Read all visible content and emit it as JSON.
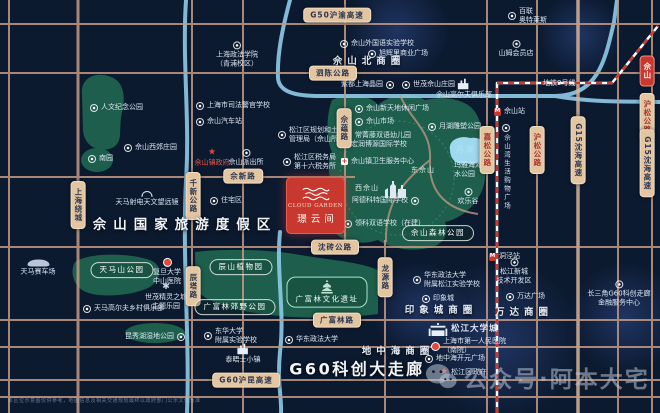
{
  "project": {
    "name_en": "CLOUD GARDEN",
    "name_cn": "璟云间"
  },
  "watermark": {
    "text": "公众号·阿本大宅"
  },
  "disclaimer": "本区位示意图仅供参考，地图信息及相关交通规划最终以政府部门公示文件为准",
  "metro": {
    "line": "地铁9号线",
    "stations": [
      "佘山站",
      "洞泾站"
    ]
  },
  "colors": {
    "background": "#0c1a30",
    "road": "#c49a85",
    "road_badge": "#e3c5a2",
    "park_green": "#1d5f4c",
    "river_blue": "#8ecbe8",
    "lake_blue": "#9ed9ef",
    "metro_red": "#cc3a31",
    "project_red": "#c9382e",
    "accent_red_text": "#e85548"
  },
  "labels": [
    {
      "n": "badge-g50-huyu-expwy",
      "k": "bh",
      "t": "G50沪渝高速",
      "x": 337,
      "y": 15
    },
    {
      "n": "badge-sichen-road",
      "k": "bh",
      "t": "泗陈公路",
      "x": 333,
      "y": 73
    },
    {
      "n": "badge-shexin-road",
      "k": "bh",
      "t": "佘新路",
      "x": 243,
      "y": 176
    },
    {
      "n": "badge-shenzhuan-road",
      "k": "bh",
      "t": "沈砖公路",
      "x": 335,
      "y": 247
    },
    {
      "n": "badge-guangfulin-road",
      "k": "bh",
      "t": "广富林路",
      "x": 337,
      "y": 320
    },
    {
      "n": "badge-g60-hukun-expwy",
      "k": "bh",
      "t": "G60沪昆高速",
      "x": 246,
      "y": 380
    },
    {
      "n": "badge-shanghai-ring-expwy",
      "k": "bv",
      "t": "上海绕城",
      "x": 78,
      "y": 205
    },
    {
      "n": "badge-qianxin-road",
      "k": "bv",
      "t": "千新公路",
      "x": 193,
      "y": 196
    },
    {
      "n": "badge-chenta-road",
      "k": "bv",
      "t": "辰塔路",
      "x": 193,
      "y": 286
    },
    {
      "n": "badge-sheyun-road",
      "k": "bv",
      "t": "佘蕴路",
      "x": 344,
      "y": 128
    },
    {
      "n": "badge-longyuan-road",
      "k": "bv",
      "t": "龙源路",
      "x": 385,
      "y": 277
    },
    {
      "n": "badge-jiasong-road",
      "k": "bvr",
      "t": "嘉松公路",
      "x": 487,
      "y": 150
    },
    {
      "n": "badge-husong-road",
      "k": "bvr",
      "t": "沪松公路",
      "x": 537,
      "y": 150
    },
    {
      "n": "badge-g15-shenhai-expwy",
      "k": "bv",
      "t": "G15沈海高速",
      "x": 578,
      "y": 150
    },
    {
      "n": "badge-sheshan-red",
      "k": "bbox",
      "t": "佘山",
      "x": 647,
      "y": 71
    },
    {
      "n": "badge-husong-road-east",
      "k": "bvr",
      "t": "沪松公路",
      "x": 647,
      "y": 117
    },
    {
      "n": "badge-g15-shenhai-expwy-east",
      "k": "bv",
      "t": "G15沈海高速",
      "x": 647,
      "y": 163
    },
    {
      "n": "park-badge-tianmashan",
      "k": "park",
      "t": "天马山公园",
      "x": 122,
      "y": 270
    },
    {
      "n": "park-badge-chenshan-botanical",
      "k": "park",
      "t": "辰山植物园",
      "x": 241,
      "y": 267
    },
    {
      "n": "park-badge-guangfulin-country",
      "k": "park",
      "t": "广富林郊野公园",
      "x": 235,
      "y": 307
    },
    {
      "n": "park-badge-guangfulin-relics",
      "k": "gpark",
      "t": "广富林文化遗址",
      "x": 327,
      "y": 292,
      "i": "pagoda",
      "ip": "above"
    },
    {
      "n": "park-badge-sheshan-forest",
      "k": "park",
      "t": "佘山森林公园",
      "x": 438,
      "y": 233
    },
    {
      "n": "title-sheshan-resort",
      "k": "title",
      "t": "佘山国家旅游度假区",
      "x": 185,
      "y": 226
    },
    {
      "n": "title-g60-corridor",
      "k": "g60",
      "t": "G60科创大走廊",
      "x": 357,
      "y": 370
    },
    {
      "n": "circle-dizhonghai",
      "k": "spread",
      "t": "地中海商圈",
      "x": 398,
      "y": 352
    },
    {
      "n": "circle-yinxiangcheng",
      "k": "spread",
      "t": "印象城商圈",
      "x": 441,
      "y": 311
    },
    {
      "n": "circle-wanda",
      "k": "spread",
      "t": "万达商圈",
      "x": 524,
      "y": 313
    },
    {
      "n": "circle-sheshan-north",
      "k": "spread",
      "t": "佘山北商圈",
      "x": 369,
      "y": 62
    },
    {
      "n": "metro-line9-label",
      "k": "poi",
      "t": "地铁9号线",
      "x": 543,
      "y": 79
    },
    {
      "n": "station-sheshan",
      "k": "poi",
      "t": "佘山站",
      "x": 494,
      "y": 107,
      "i": "metro"
    },
    {
      "n": "station-dongjing",
      "k": "poi",
      "t": "洞泾站",
      "x": 489,
      "y": 252,
      "i": "metro"
    },
    {
      "n": "poi-renwen-memorial-park",
      "k": "poi",
      "t": "人文纪念公园",
      "x": 90,
      "y": 103,
      "i": "circle"
    },
    {
      "n": "poi-nanyuan",
      "k": "poi",
      "t": "南园",
      "x": 88,
      "y": 154,
      "i": "circle"
    },
    {
      "n": "poi-sheshan-xijiao-manor",
      "k": "poi",
      "t": "佘山西郊庄园",
      "x": 124,
      "y": 143,
      "i": "circle"
    },
    {
      "n": "poi-shanghai-univ-political-law",
      "k": "poic",
      "L": [
        "上海政法学院",
        "（青浦校区）"
      ],
      "x": 237,
      "y": 55,
      "i": "circle",
      "ip": "above"
    },
    {
      "n": "poi-judicial-police-school",
      "k": "poi",
      "t": "上海市司法警官学校",
      "x": 196,
      "y": 101,
      "i": "circle"
    },
    {
      "n": "poi-sheshan-bus-station",
      "k": "poi",
      "t": "佘山汽车站",
      "x": 196,
      "y": 117,
      "i": "circle"
    },
    {
      "n": "poi-planning-land-bureau",
      "k": "poi",
      "L": [
        "松江区规划和土地",
        "管理局（佘山所）"
      ],
      "x": 278,
      "y": 126,
      "i": "circle"
    },
    {
      "n": "poi-tax-office-16",
      "k": "poi",
      "L": [
        "松江区税务局",
        "第十六税务所"
      ],
      "x": 283,
      "y": 153,
      "i": "circle"
    },
    {
      "n": "poi-sheshan-town-gov",
      "k": "poic",
      "t": "佘山镇政府",
      "x": 212,
      "y": 158,
      "i": "star",
      "ip": "above",
      "red": 1
    },
    {
      "n": "poi-sheshan-police-station",
      "k": "poic",
      "t": "佘山派出所",
      "x": 246,
      "y": 158,
      "i": "circle",
      "ip": "above"
    },
    {
      "n": "poi-residential-area",
      "k": "poi",
      "t": "住宅区",
      "x": 210,
      "y": 196,
      "i": "circle"
    },
    {
      "n": "poi-tianma-radio-telescope",
      "k": "poic",
      "t": "天马射电天文望远镜",
      "x": 147,
      "y": 199,
      "i": "dish",
      "ip": "above"
    },
    {
      "n": "poi-tianma-circuit",
      "k": "poic",
      "t": "天马赛车场",
      "x": 38,
      "y": 268,
      "i": "car",
      "ip": "above"
    },
    {
      "n": "poi-fudan-zhongshan-hospital",
      "k": "poic",
      "L": [
        "复旦大学",
        "中山医院"
      ],
      "x": 167,
      "y": 272,
      "i": "pin",
      "ip": "above"
    },
    {
      "n": "poi-shimao-elf-city",
      "k": "poic",
      "L": [
        "世茂精灵之城",
        "主题乐园"
      ],
      "x": 166,
      "y": 297,
      "i": "gear",
      "ip": "above"
    },
    {
      "n": "poi-tianma-golf-club",
      "k": "poi",
      "t": "天马高尔夫乡村俱乐部",
      "x": 83,
      "y": 304,
      "i": "circle"
    },
    {
      "n": "poi-kunxiu-lake-wetland",
      "k": "poi",
      "t": "昆秀湖湿地公园",
      "x": 125,
      "y": 332,
      "i": "circle",
      "ip": "right"
    },
    {
      "n": "poi-donghua-univ-school",
      "k": "poi",
      "L": [
        "东华大学",
        "附属实验学校"
      ],
      "x": 204,
      "y": 327,
      "i": "circle"
    },
    {
      "n": "poi-thames-town",
      "k": "poic",
      "t": "泰晤士小镇",
      "x": 243,
      "y": 354,
      "i": "building",
      "ip": "above"
    },
    {
      "n": "poi-ecupl",
      "k": "poi",
      "t": "华东政法大学",
      "x": 285,
      "y": 335,
      "i": "circle"
    },
    {
      "n": "poi-sheshan-foreign-language-school",
      "k": "poi",
      "t": "佘山外国语实验学校",
      "x": 340,
      "y": 39,
      "i": "circle"
    },
    {
      "n": "poi-xuhuili-plaza",
      "k": "poi",
      "t": "旭辉里商业广场",
      "x": 368,
      "y": 49,
      "i": "circle"
    },
    {
      "n": "poi-sams-club",
      "k": "poic",
      "t": "山姆会员店",
      "x": 516,
      "y": 49,
      "i": "circle",
      "ip": "above"
    },
    {
      "n": "poi-bailian-outlets",
      "k": "poi",
      "L": [
        "百联",
        "奥特莱斯"
      ],
      "x": 508,
      "y": 7,
      "i": "circle"
    },
    {
      "n": "poi-zidu-shanghai-jingyuan",
      "k": "poi",
      "t": "紫都上海晶园",
      "x": 341,
      "y": 80,
      "i": "circle",
      "ip": "right"
    },
    {
      "n": "poi-shimao-sheshan-manor",
      "k": "poi",
      "t": "世茂佘山庄园",
      "x": 402,
      "y": 80,
      "i": "circle"
    },
    {
      "n": "poi-sheshan-golf-club",
      "k": "poic",
      "t": "佘山高尔夫俱乐部",
      "x": 464,
      "y": 89,
      "i": "building",
      "ip": "above"
    },
    {
      "n": "poi-sheshan-xintiandi-plaza",
      "k": "poi",
      "t": "佘山新天地休闲广场",
      "x": 355,
      "y": 104,
      "i": "circle"
    },
    {
      "n": "poi-sheshan-market",
      "k": "poi",
      "t": "佘山市场",
      "x": 355,
      "y": 117,
      "i": "circle"
    },
    {
      "n": "poi-changjingteng-kindergarten",
      "k": "poi",
      "t": "常菁藤双语幼儿园",
      "x": 355,
      "y": 131
    },
    {
      "n": "poi-international-school",
      "k": "poi",
      "t": "宏润博源国际学校",
      "x": 351,
      "y": 140
    },
    {
      "n": "poi-sheshan-health-center",
      "k": "poi",
      "t": "佘山镇卫生服务中心",
      "x": 341,
      "y": 157,
      "i": "cross"
    },
    {
      "n": "label-west-sheshan",
      "k": "hill",
      "t": "西佘山",
      "x": 355,
      "y": 180,
      "i": "church",
      "ip": "right"
    },
    {
      "n": "label-east-sheshan",
      "k": "hill",
      "t": "东佘山",
      "x": 411,
      "y": 166
    },
    {
      "n": "poi-yuehu-sculpture-park",
      "k": "poi",
      "t": "月湖雕塑公园",
      "x": 428,
      "y": 122,
      "i": "circle"
    },
    {
      "n": "label-yuehu-lake",
      "k": "lake",
      "t": "月湖",
      "x": 456,
      "y": 145
    },
    {
      "n": "poi-maya-beach-waterpark",
      "k": "poic",
      "L": [
        "玛雅海滩",
        "水公园"
      ],
      "x": 468,
      "y": 170
    },
    {
      "n": "poi-happy-valley",
      "k": "poic",
      "t": "欢乐谷",
      "x": 468,
      "y": 197,
      "i": "circle",
      "ip": "above"
    },
    {
      "n": "poi-adcote-school",
      "k": "poi",
      "t": "阿德科特国际学校",
      "x": 352,
      "y": 196,
      "i": "circle",
      "ip": "right"
    },
    {
      "n": "poi-ulink-school",
      "k": "poi",
      "t": "领科双语学校（在建）",
      "x": 344,
      "y": 219,
      "i": "circle"
    },
    {
      "n": "poi-sheshanwan-mall",
      "k": "vt",
      "t": "佘山湾生活购物广场",
      "x": 502,
      "y": 124,
      "i": "circle"
    },
    {
      "n": "poi-ecupl-songjiang-school",
      "k": "poi",
      "L": [
        "华东政法大学",
        "附属松江实验学校"
      ],
      "x": 413,
      "y": 271,
      "i": "circle"
    },
    {
      "n": "poi-yinxiangcheng-mall",
      "k": "poi",
      "t": "印象城",
      "x": 422,
      "y": 294,
      "i": "circle"
    },
    {
      "n": "poi-songjiang-university-town",
      "k": "poib",
      "t": "松江大学城",
      "x": 428,
      "y": 323,
      "i": "gate"
    },
    {
      "n": "poi-first-peoples-hospital",
      "k": "poi",
      "L": [
        "上海市第一人民医院",
        "（南院）"
      ],
      "x": 431,
      "y": 337,
      "i": "pin"
    },
    {
      "n": "poi-dizhonghai-kaiyuan-plaza",
      "k": "poi",
      "t": "地中海开元广场",
      "x": 425,
      "y": 354,
      "i": "circle"
    },
    {
      "n": "poi-songjiang-gov",
      "k": "poi",
      "t": "松江区政府",
      "x": 440,
      "y": 368,
      "i": "star"
    },
    {
      "n": "poi-songjiang-newcity-tech-zone",
      "k": "poic",
      "L": [
        "松江新城",
        "技术开发区"
      ],
      "x": 514,
      "y": 272,
      "i": "circle",
      "ip": "above"
    },
    {
      "n": "poi-wanda-plaza",
      "k": "poi",
      "t": "万达广场",
      "x": 506,
      "y": 292,
      "i": "circle"
    },
    {
      "n": "poi-g60-finance-center",
      "k": "poic",
      "L": [
        "长三角G60科创走廊",
        "金融服务中心"
      ],
      "x": 619,
      "y": 294,
      "i": "circle",
      "ip": "above"
    }
  ]
}
